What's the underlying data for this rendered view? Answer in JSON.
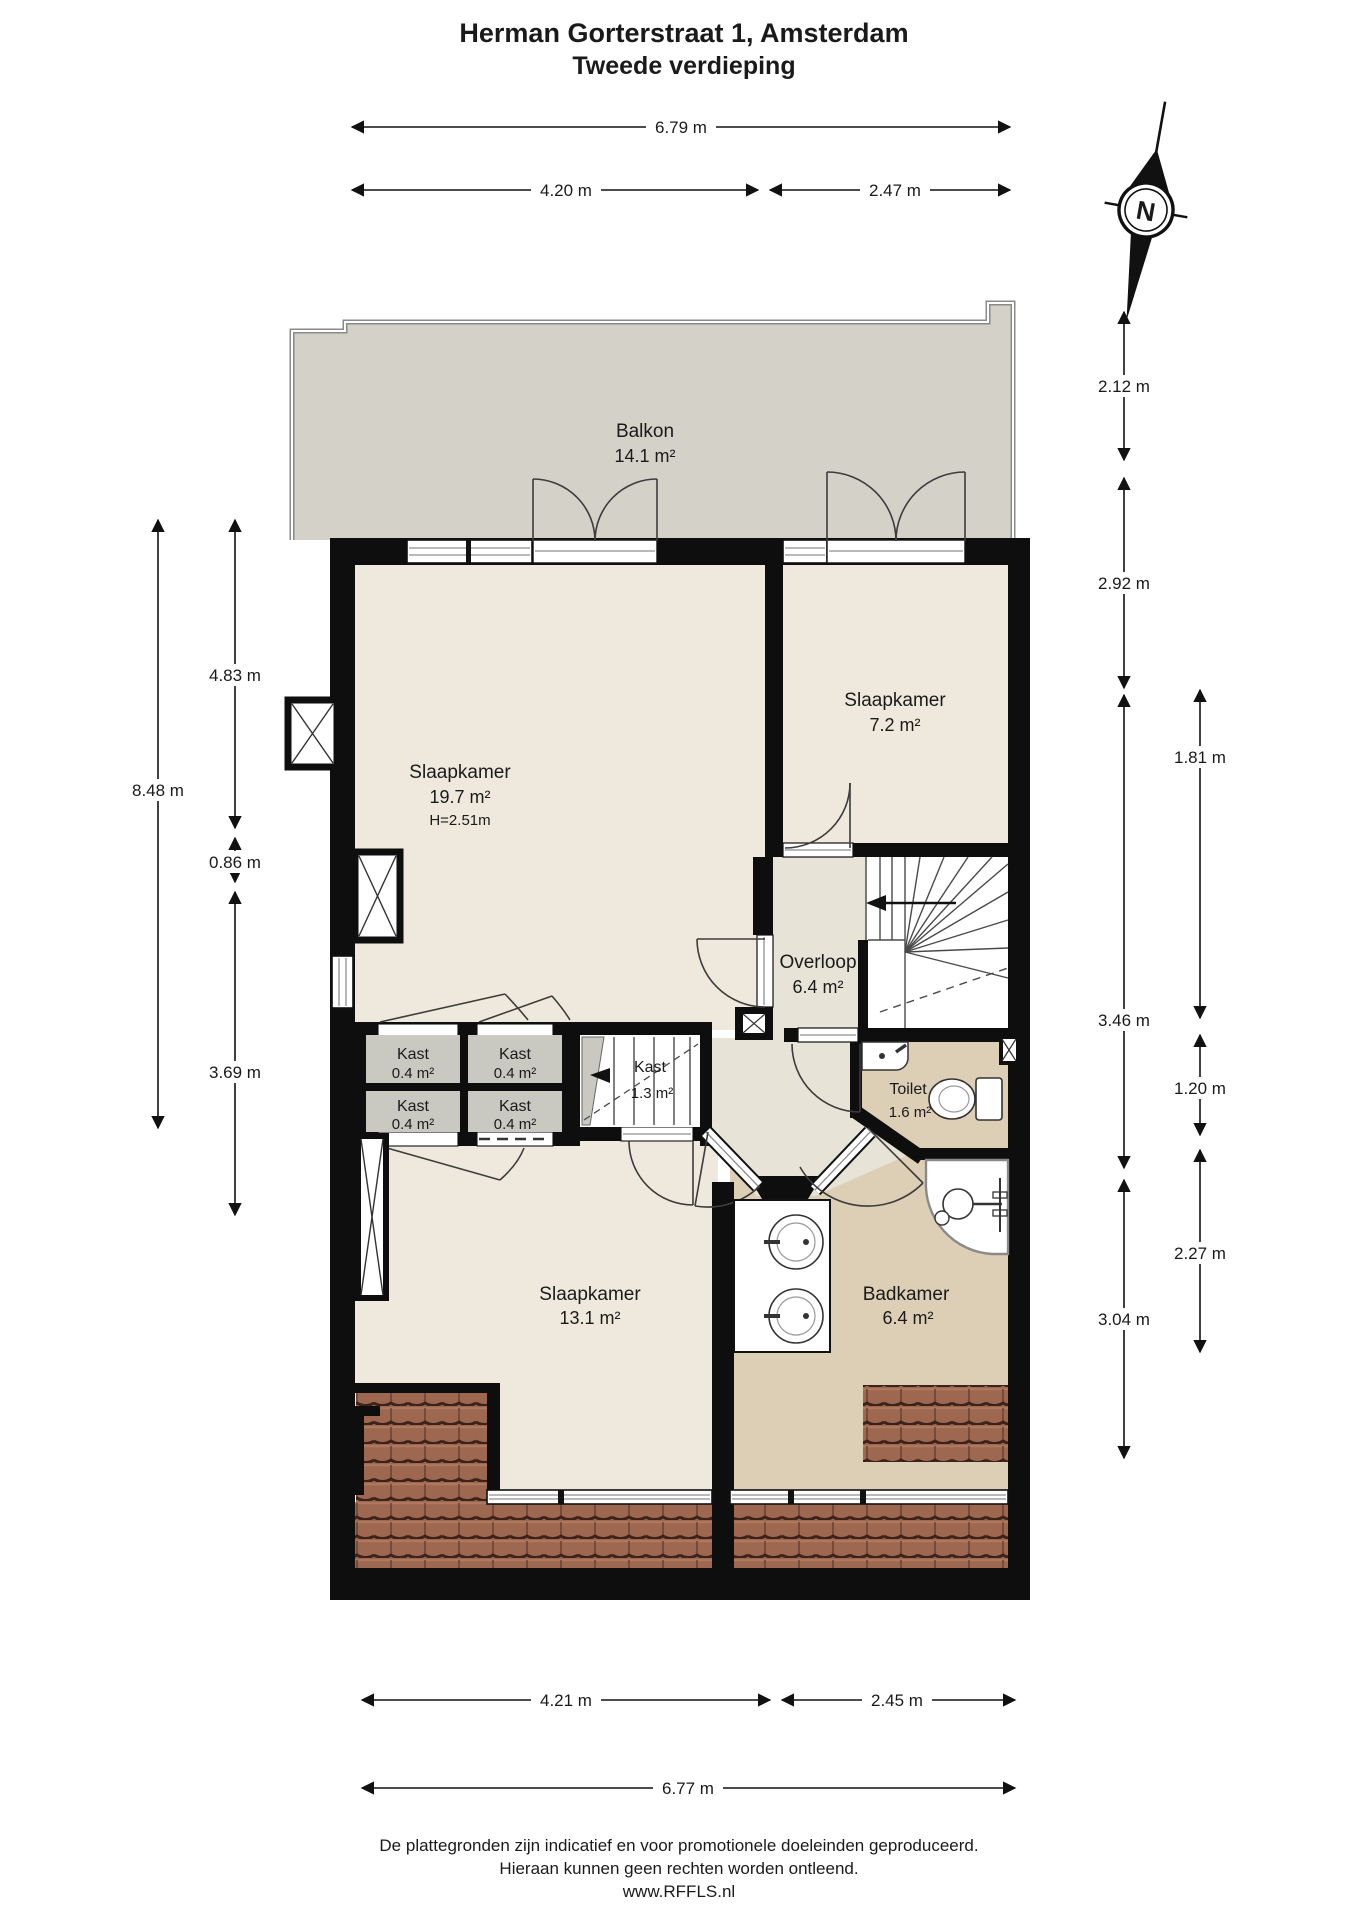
{
  "title": {
    "line1": "Herman Gorterstraat 1, Amsterdam",
    "line2": "Tweede verdieping"
  },
  "compass": {
    "north": "N"
  },
  "rooms": {
    "balkon": {
      "name": "Balkon",
      "area": "14.1 m²"
    },
    "slaapkamer_voor": {
      "name": "Slaapkamer",
      "area": "19.7 m²",
      "height": "H=2.51m"
    },
    "slaapkamer_rechts": {
      "name": "Slaapkamer",
      "area": "7.2 m²"
    },
    "overloop": {
      "name": "Overloop",
      "area": "6.4 m²"
    },
    "kast_klein": {
      "name": "Kast",
      "area": "0.4 m²"
    },
    "kast_groot": {
      "name": "Kast",
      "area": "1.3 m²"
    },
    "toilet": {
      "name": "Toilet",
      "area": "1.6 m²"
    },
    "slaapkamer_achter": {
      "name": "Slaapkamer",
      "area": "13.1 m²"
    },
    "badkamer": {
      "name": "Badkamer",
      "area": "6.4 m²"
    }
  },
  "dimensions": {
    "top_total": "6.79 m",
    "top_left": "4.20 m",
    "top_right": "2.47 m",
    "right_1": "2.12 m",
    "right_2": "2.92 m",
    "right_3": "3.46 m",
    "right_4": "3.04 m",
    "right_outer_1": "1.81 m",
    "right_outer_2": "1.20 m",
    "right_outer_3": "2.27 m",
    "left_total": "8.48 m",
    "left_1": "4.83 m",
    "left_2": "0.86 m",
    "left_3": "3.69 m",
    "bottom_left": "4.21 m",
    "bottom_right": "2.45 m",
    "bottom_total": "6.77 m"
  },
  "colors": {
    "wall": "#0e0e0e",
    "balcony_floor": "#d4d1c8",
    "bedroom_floor": "#eee9dc",
    "hall_floor": "#e7e3d7",
    "bath_floor": "#dccfb6",
    "closet_floor": "#c9c9c2",
    "roof_tile": "#9d6750"
  },
  "footer": {
    "line1": "De plattegronden zijn indicatief en voor promotionele doeleinden geproduceerd.",
    "line2": "Hieraan kunnen geen rechten worden ontleend.",
    "line3": "www.RFFLS.nl"
  }
}
